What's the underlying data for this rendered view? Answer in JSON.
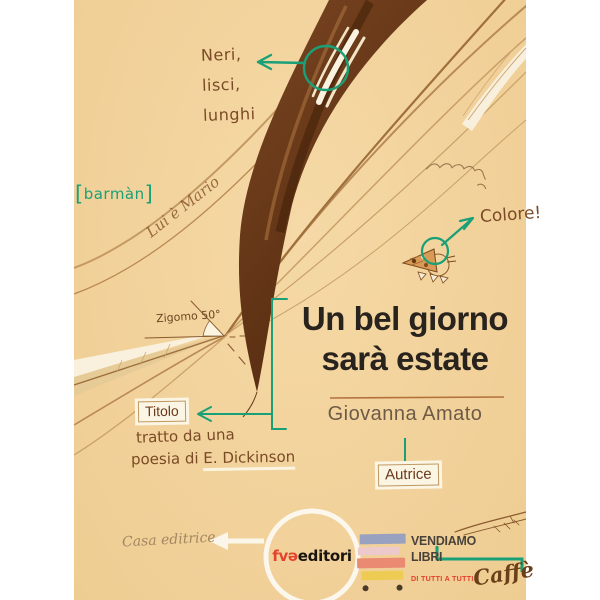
{
  "cover": {
    "annotations": {
      "hair_note": {
        "lines": [
          "Neri,",
          "lisci,",
          "lunghi"
        ]
      },
      "barman": "barmàn",
      "lui_e_mario": "Lui è Mario",
      "colore": "Colore!",
      "zigomo": "Zigomo 50°",
      "titolo_label": "Titolo",
      "titolo_caption_line1": "tratto da una",
      "titolo_caption_line2a": "poesia di",
      "titolo_caption_line2b": "E. Dickinson",
      "autrice_label": "Autrice",
      "casa_editrice": "Casa editrice",
      "caffe": "Caffè"
    },
    "title": {
      "line1": "Un bel giorno",
      "line2": "sarà estate"
    },
    "author": "Giovanna Amato",
    "publisher": {
      "logo_red": "fvə",
      "logo_black": "editori"
    },
    "vendiamo": {
      "line1": "VENDIAMO",
      "line2": "LIBRI",
      "tagline": "DI TUTTI A TUTTI",
      "book_colors": [
        "#99a1c0",
        "#ecc9cb",
        "#ea8a72",
        "#eecb52"
      ]
    },
    "palette": {
      "background": "#f2d29b",
      "accent_teal": "#1aa077",
      "ink_brown": "#7a4a26",
      "hair_dark": "#5e3315",
      "title_color": "#29231e",
      "author_color": "#6e5b47",
      "logo_red": "#e5432d",
      "tagline_red": "#e2402c",
      "paper_white": "#fbf4e2"
    }
  }
}
